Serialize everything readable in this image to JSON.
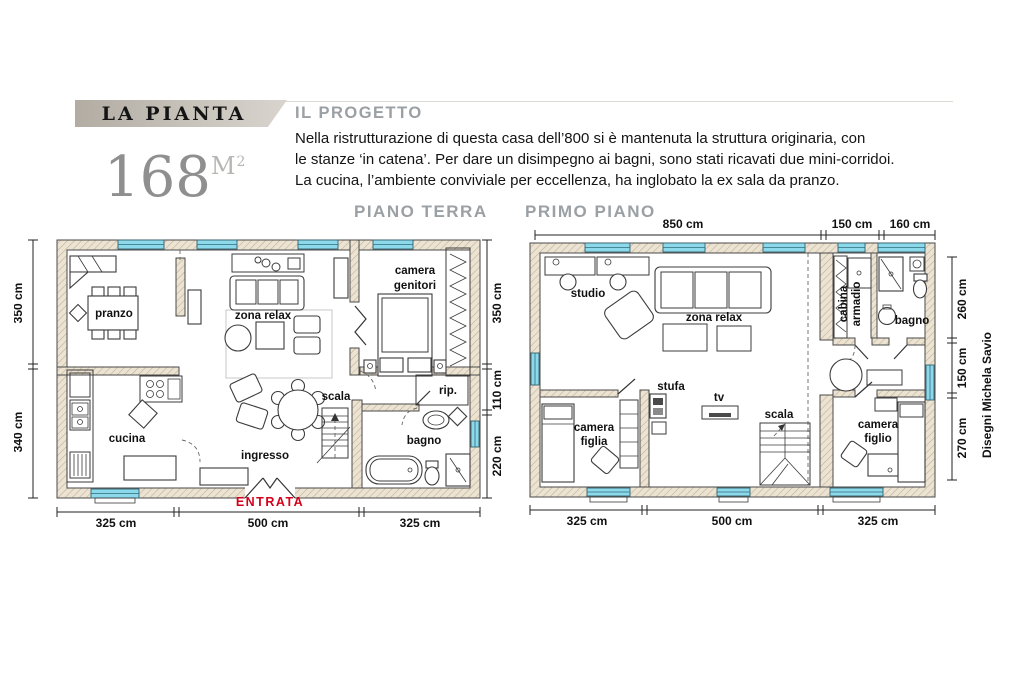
{
  "header": {
    "banner_title": "LA PIANTA",
    "area_number": "168",
    "area_unit": "M",
    "area_exponent": "2"
  },
  "project": {
    "heading": "IL PROGETTO",
    "line1": "Nella ristrutturazione di questa casa dell’800 si è mantenuta la struttura originaria, con",
    "line2": "le stanze ‘in catena’. Per dare un disimpegno ai bagni, sono stati ricavati due mini-corridoi.",
    "line3": "La cucina, l’ambiente conviviale per eccellenza, ha inglobato la ex sala da pranzo."
  },
  "plans": {
    "ground": {
      "title": "PIANO TERRA",
      "labels": {
        "pranzo": "pranzo",
        "cucina": "cucina",
        "zona_relax": "zona relax",
        "ingresso": "ingresso",
        "scala": "scala",
        "rip": "rip.",
        "bagno": "bagno",
        "camera_line1": "camera",
        "camera_line2": "genitori",
        "entrata": "ENTRATA"
      },
      "dims": {
        "left_top": "350 cm",
        "left_bottom": "340 cm",
        "right_top": "350 cm",
        "right_mid": "110 cm",
        "right_bottom": "220 cm",
        "bottom_left": "325 cm",
        "bottom_center": "500 cm",
        "bottom_right": "325 cm"
      }
    },
    "first": {
      "title": "PRIMO PIANO",
      "labels": {
        "studio": "studio",
        "zona_relax": "zona relax",
        "stufa": "stufa",
        "tv": "tv",
        "scala": "scala",
        "cabina_line1": "cabina",
        "cabina_line2": "armadio",
        "bagno": "bagno",
        "figlia_line1": "camera",
        "figlia_line2": "figlia",
        "figlio_line1": "camera",
        "figlio_line2": "figlio"
      },
      "dims": {
        "top_left": "850 cm",
        "top_mid": "150 cm",
        "top_right": "160 cm",
        "right_top": "260 cm",
        "right_mid": "150 cm",
        "right_bottom": "270 cm",
        "bottom_left": "325 cm",
        "bottom_center": "500 cm",
        "bottom_right": "325 cm"
      }
    }
  },
  "credit": "Disegni Michela Savio",
  "colors": {
    "window_glass": "#8dd9ec",
    "wall_fill": "#ece3d3",
    "wall_hatch": "#bfb296",
    "entrance_red": "#d6001c",
    "heading_gray": "#9aa0a4",
    "banner_gray": "#c9c3bb",
    "area_gray": "#8f8f8f"
  }
}
